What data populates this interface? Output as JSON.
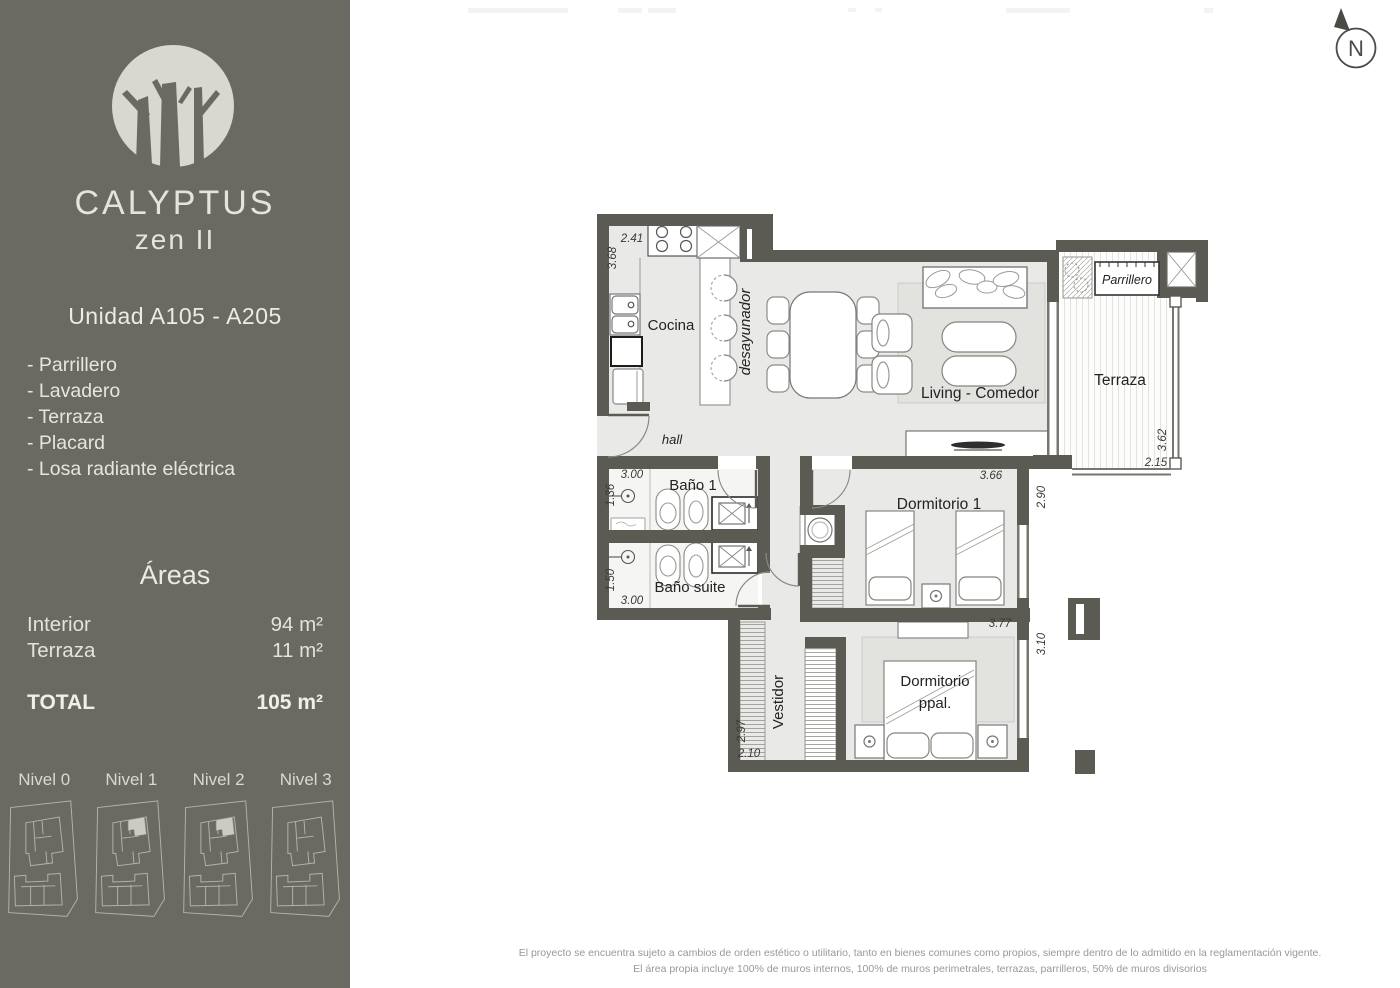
{
  "sidebar": {
    "brand": {
      "name": "CALYPTUS",
      "edition": "zen II"
    },
    "unit_title": "Unidad A105 - A205",
    "features": [
      "- Parrillero",
      "- Lavadero",
      "- Terraza",
      "- Placard",
      "- Losa radiante eléctrica"
    ],
    "areas": {
      "heading": "Áreas",
      "rows": [
        {
          "label": "Interior",
          "value": "94 m²"
        },
        {
          "label": "Terraza",
          "value": "11 m²"
        }
      ],
      "total_label": "TOTAL",
      "total_value": "105 m²"
    },
    "levels": [
      {
        "label": "Nivel 0",
        "highlighted": false
      },
      {
        "label": "Nivel 1",
        "highlighted": true
      },
      {
        "label": "Nivel 2",
        "highlighted": true
      },
      {
        "label": "Nivel 3",
        "highlighted": false
      }
    ]
  },
  "plan": {
    "north_label": "N",
    "rooms": {
      "cocina": "Cocina",
      "desayunador": "desayunador",
      "hall": "hall",
      "bano1": "Baño 1",
      "bano_suite": "Baño suite",
      "dormitorio1": "Dormitorio 1",
      "vestidor": "Vestidor",
      "dormitorio_ppal_l1": "Dormitorio",
      "dormitorio_ppal_l2": "ppal.",
      "living": "Living - Comedor",
      "terraza": "Terraza",
      "parrillero": "Parrillero"
    },
    "dims": {
      "cocina_ancho": "2.41",
      "cocina_largo": "3.68",
      "bano1_ancho": "3.00",
      "bano1_alto": "1.36",
      "bano_suite_alto": "1.50",
      "bano_suite_ancho": "3.00",
      "vestidor_alto": "2.97",
      "vestidor_ancho": "2.10",
      "dorm1_ancho": "3.66",
      "dorm1_alto": "2.90",
      "dorm_ppal_ancho": "3.77",
      "dorm_ppal_alto": "3.10",
      "terraza_alto": "3.62",
      "terraza_ancho": "2.15"
    }
  },
  "footer": {
    "line1": "El proyecto se encuentra sujeto a cambios de orden estético o utilitario, tanto en bienes comunes como propios, siempre dentro de lo admitido en la reglamentación vigente.",
    "line2": "El área propia incluye 100% de muros internos, 100% de muros perimetrales, terrazas, parrilleros, 50% de muros divisorios"
  },
  "colors": {
    "sidebar_bg": "#6b6a62",
    "wall": "#5c5b53",
    "floor": "#e9e9e7",
    "highlight_unit": "#cbcac3",
    "text_light": "#e4e3dc"
  }
}
